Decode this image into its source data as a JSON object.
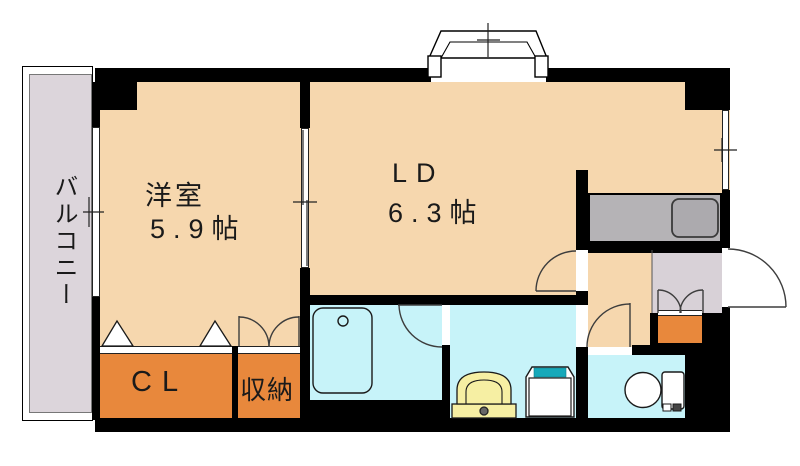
{
  "floorplan": {
    "balcony": {
      "label": "バルコニー"
    },
    "western_room": {
      "label": "洋室",
      "size": "5.9帖"
    },
    "living_dining": {
      "label": "LD",
      "size": "6.3帖"
    },
    "closet": {
      "label": "CL"
    },
    "storage": {
      "label": "収納"
    },
    "colors": {
      "room_floor": "#F6D7AE",
      "storage_floor": "#E8883C",
      "wet_area_floor": "#C7F3F9",
      "balcony_floor": "#DCD5DB",
      "entrance_floor": "#D8D1D7",
      "kitchen_counter": "#B5B3B6",
      "wall": "#000000",
      "washer_accent": "#17A9BA",
      "vanity": "#F6EFA3"
    }
  }
}
